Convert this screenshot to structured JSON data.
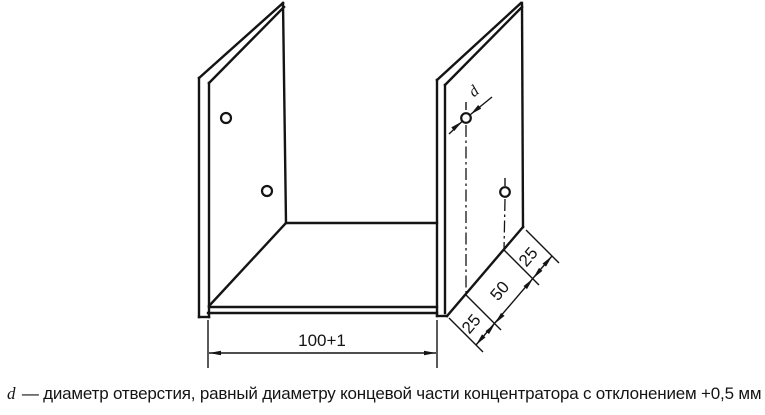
{
  "drawing": {
    "description": "Axonometric technical drawing of a U-shaped channel bracket with holes",
    "dimensions": {
      "width_label": "100+1",
      "chain_labels": [
        "25",
        "50",
        "25"
      ],
      "hole_diameter_label": "d"
    },
    "caption": {
      "symbol": "d",
      "text": "— диаметр отверстия, равный диаметру концевой части концентратора с отклонением +0,5 мм"
    },
    "colors": {
      "line": "#141414",
      "background": "#ffffff"
    }
  }
}
